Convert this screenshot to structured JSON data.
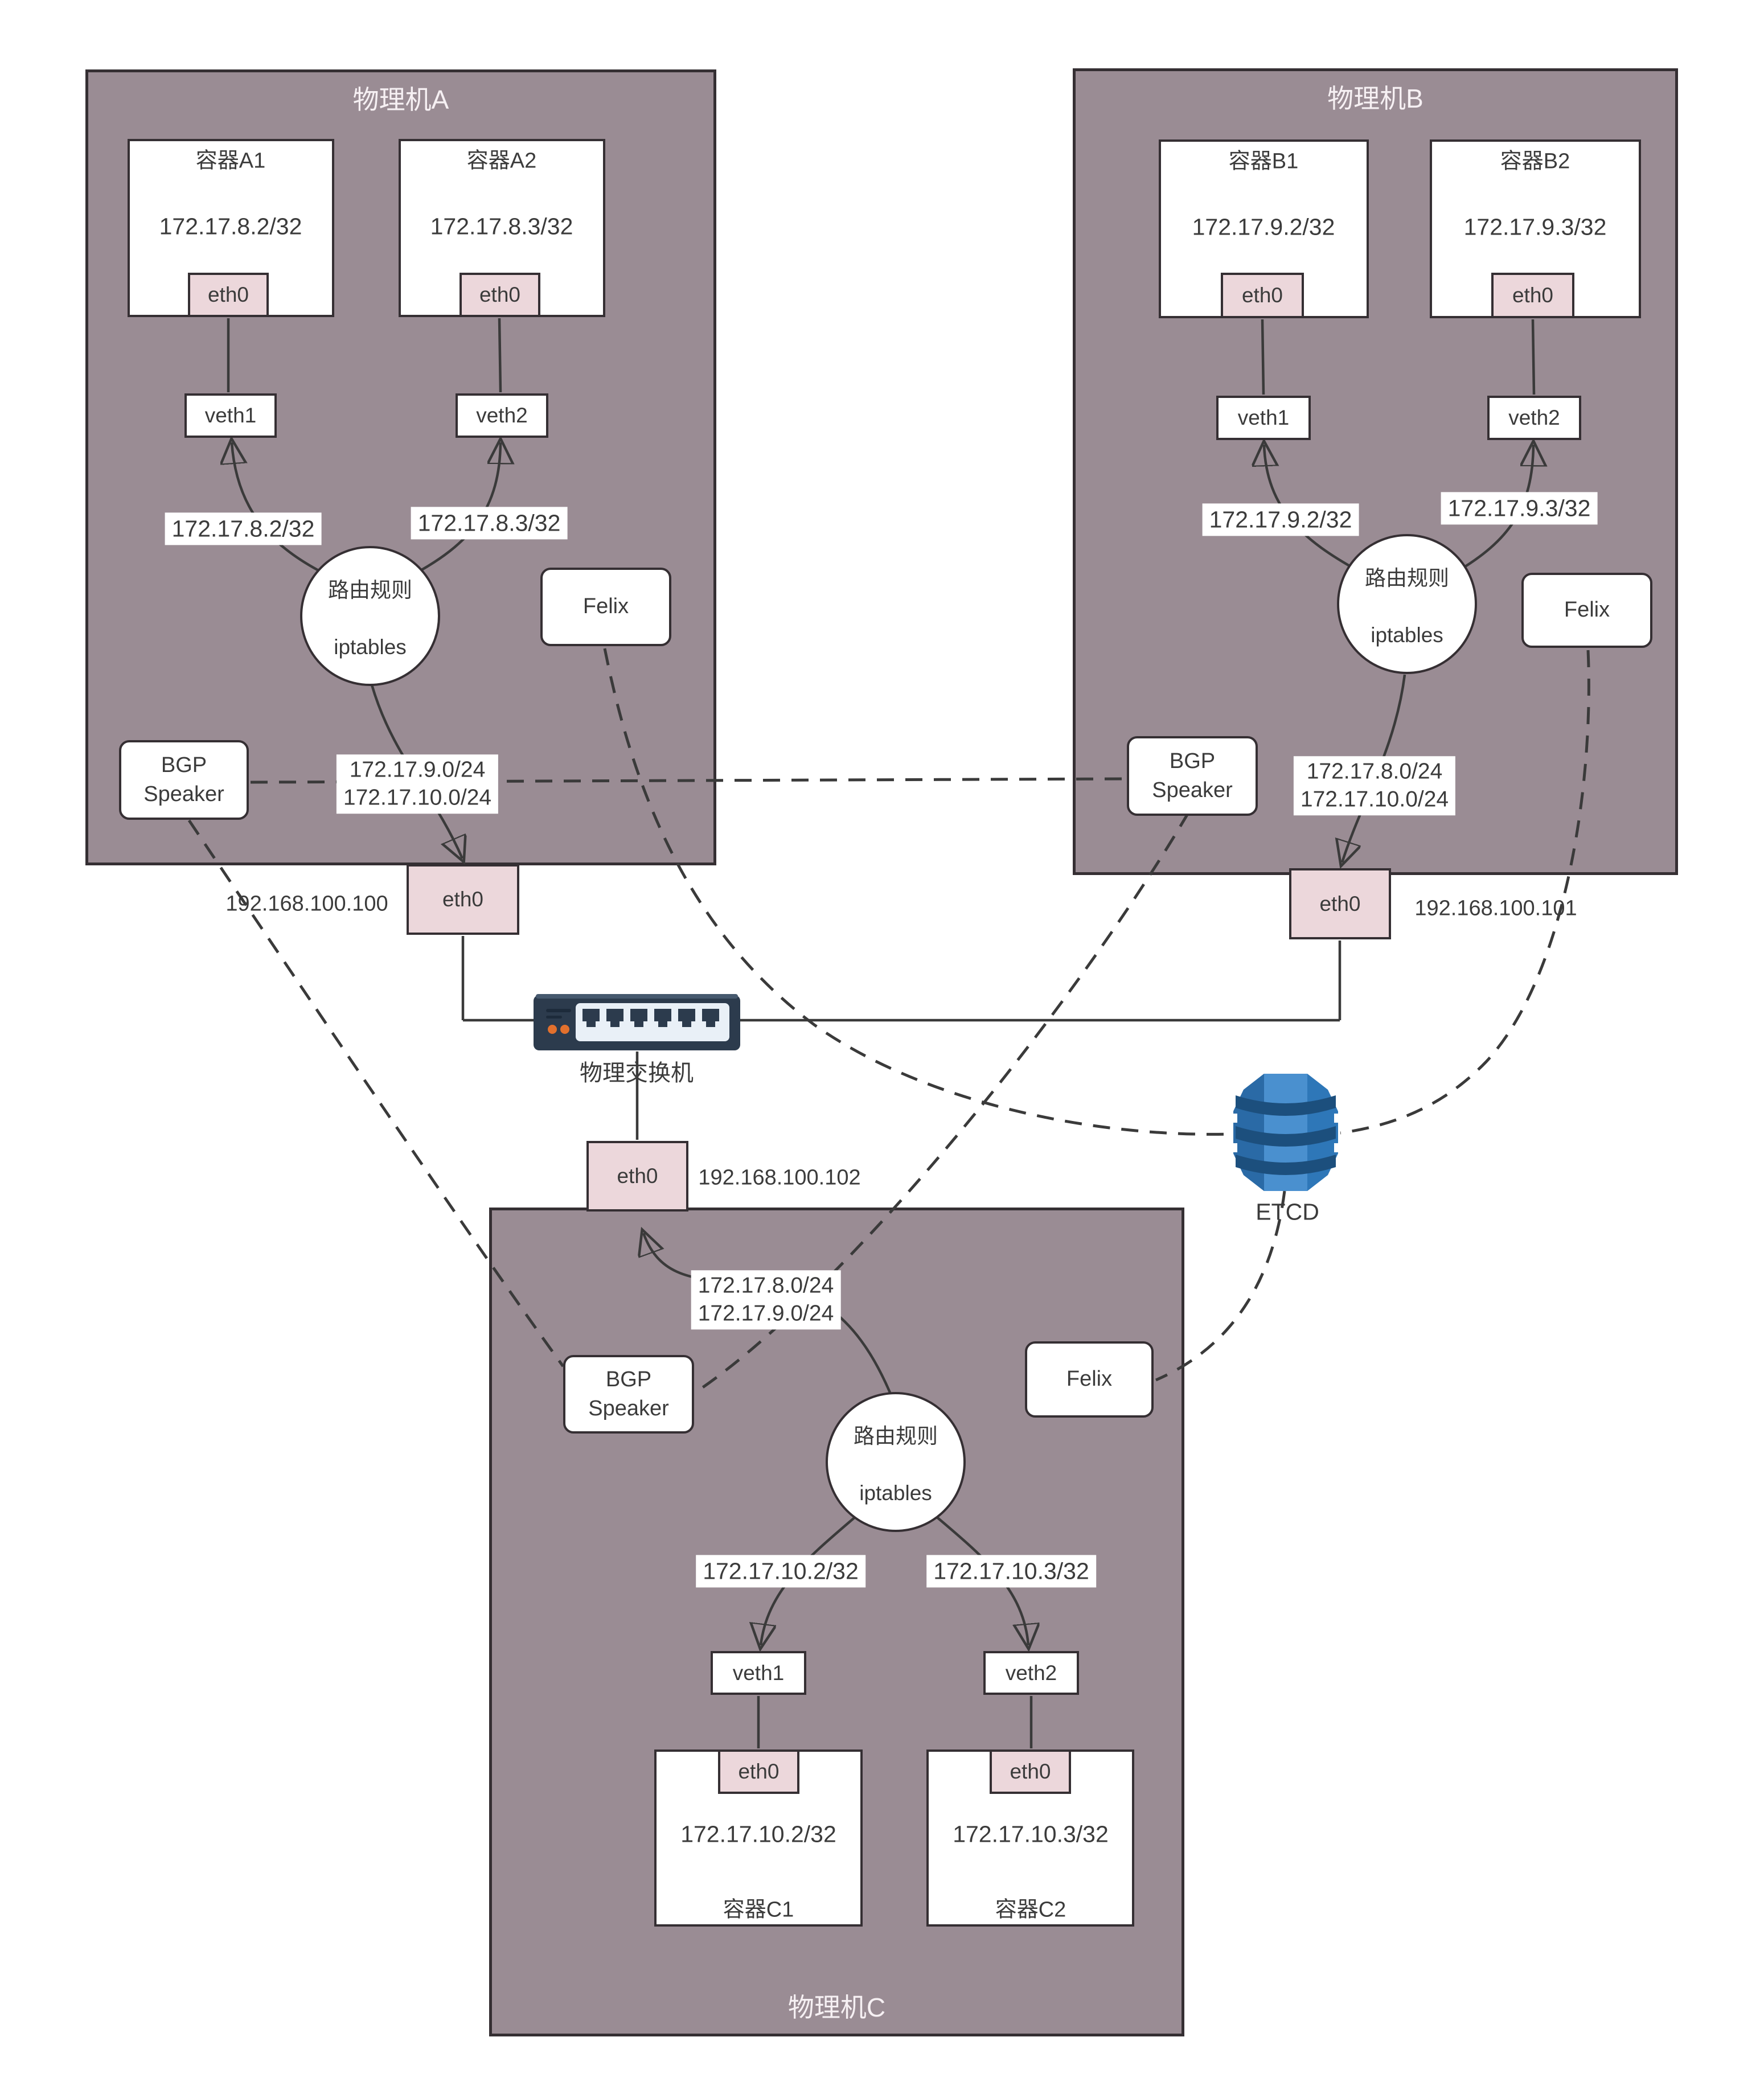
{
  "machineA": {
    "title": "物理机A",
    "containers": [
      {
        "name": "容器A1",
        "ip": "172.17.8.2/32",
        "eth": "eth0"
      },
      {
        "name": "容器A2",
        "ip": "172.17.8.3/32",
        "eth": "eth0"
      }
    ],
    "veths": [
      "veth1",
      "veth2"
    ],
    "route_labels": [
      "172.17.8.2/32",
      "172.17.8.3/32"
    ],
    "circle": {
      "line1": "路由规则",
      "line2": "iptables"
    },
    "felix": "Felix",
    "bgp": "BGP\nSpeaker",
    "egress_label": "172.17.9.0/24\n172.17.10.0/24",
    "host_eth": "eth0",
    "host_ip": "192.168.100.100"
  },
  "machineB": {
    "title": "物理机B",
    "containers": [
      {
        "name": "容器B1",
        "ip": "172.17.9.2/32",
        "eth": "eth0"
      },
      {
        "name": "容器B2",
        "ip": "172.17.9.3/32",
        "eth": "eth0"
      }
    ],
    "veths": [
      "veth1",
      "veth2"
    ],
    "route_labels": [
      "172.17.9.2/32",
      "172.17.9.3/32"
    ],
    "circle": {
      "line1": "路由规则",
      "line2": "iptables"
    },
    "felix": "Felix",
    "bgp": "BGP\nSpeaker",
    "egress_label": "172.17.8.0/24\n172.17.10.0/24",
    "host_eth": "eth0",
    "host_ip": "192.168.100.101"
  },
  "machineC": {
    "title": "物理机C",
    "containers": [
      {
        "name": "容器C1",
        "ip": "172.17.10.2/32",
        "eth": "eth0"
      },
      {
        "name": "容器C2",
        "ip": "172.17.10.3/32",
        "eth": "eth0"
      }
    ],
    "veths": [
      "veth1",
      "veth2"
    ],
    "route_labels": [
      "172.17.10.2/32",
      "172.17.10.3/32"
    ],
    "circle": {
      "line1": "路由规则",
      "line2": "iptables"
    },
    "felix": "Felix",
    "bgp": "BGP\nSpeaker",
    "uplink_label": "172.17.8.0/24\n172.17.9.0/24",
    "host_eth": "eth0",
    "host_ip": "192.168.100.102"
  },
  "switch": {
    "label": "物理交换机"
  },
  "etcd": {
    "label": "ETCD"
  },
  "colors": {
    "machine_fill": "#9A8C94",
    "box_border": "#352F33",
    "eth_fill": "#ECD7DB",
    "line": "#3A3A3A",
    "switch_body": "#2C3B4D",
    "switch_panel": "#E9F0F7",
    "led_orange": "#E2702D",
    "etcd_blue": "#2E77B8",
    "etcd_blue_light": "#4A90CF",
    "etcd_blue_dark": "#1C4F7D"
  }
}
